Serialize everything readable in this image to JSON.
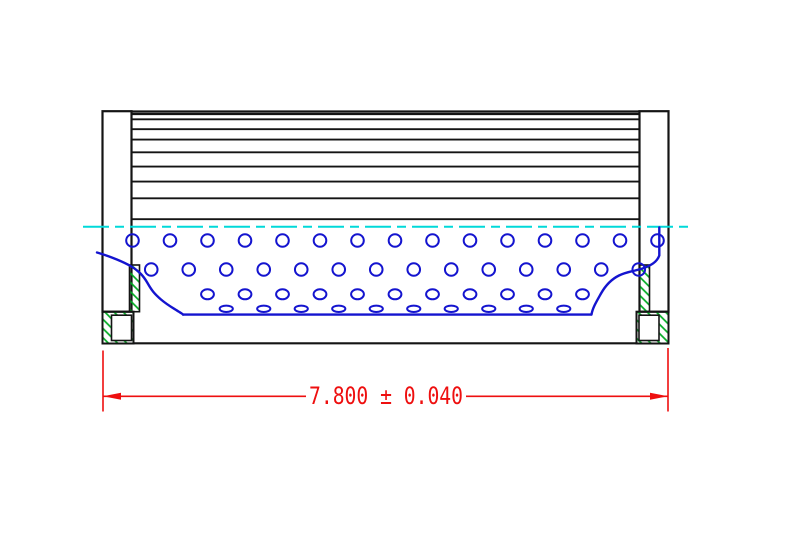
{
  "drawing": {
    "type": "cad-section-view-filter-element",
    "dimension": {
      "label": "7.800 ± 0.040",
      "nominal": "7.800",
      "tolerance": "0.040"
    },
    "colors": {
      "background": "#ffffff",
      "outline": "#141414",
      "perforation_blue": "#1414cf",
      "centerline_cyan": "#00d9d9",
      "hatch_green": "#00aa22",
      "dimension_red": "#ee0f0f"
    },
    "geometry": {
      "caps": [
        {
          "x": 102.5,
          "y": 111.2,
          "w": 29,
          "h": 200.5
        },
        {
          "x": 639.5,
          "y": 111.2,
          "w": 29,
          "h": 200.5
        }
      ],
      "strips": [
        {
          "x": 129.5,
          "y": 265,
          "w": 10,
          "h": 46.7
        },
        {
          "x": 639.5,
          "y": 265,
          "w": 10,
          "h": 46.7
        }
      ],
      "blocks": [
        {
          "outer": {
            "x": 102.5,
            "y": 311.7,
            "w": 31,
            "h": 31.8
          },
          "notch": {
            "x": 111.5,
            "y": 315.2,
            "w": 20,
            "h": 25.3
          }
        },
        {
          "outer": {
            "x": 636.5,
            "y": 311.7,
            "w": 32,
            "h": 31.8
          },
          "notch": {
            "x": 639.0,
            "y": 315.2,
            "w": 20,
            "h": 25.3
          }
        }
      ],
      "pleat_lines": {
        "x1": 131.5,
        "x2": 639.5,
        "ys": [
          111.5,
          114.0,
          119.3,
          129.2,
          139.6,
          152.3,
          166.6,
          181.6,
          198.3,
          219.2
        ]
      },
      "body_bottom": {
        "x1": 133.5,
        "x2": 636.5,
        "y": 343.3
      },
      "centerline": {
        "x1": 83,
        "x2": 690,
        "y": 226.8,
        "dash": "26 6 9 6"
      },
      "hole_rows": [
        {
          "cy": 240.5,
          "rx": 6.3,
          "ry": 6.3,
          "x0": 132.5,
          "dx": 37.5,
          "n": 15
        },
        {
          "cy": 269.5,
          "rx": 6.3,
          "ry": 6.3,
          "x0": 151.25,
          "dx": 37.5,
          "n": 14
        },
        {
          "cy": 294.3,
          "rx": 6.4,
          "ry": 5.0,
          "x0": 207.5,
          "dx": 37.5,
          "n": 11
        },
        {
          "cy": 308.8,
          "rx": 6.6,
          "ry": 3.2,
          "x0": 226.25,
          "dx": 37.5,
          "n": 10
        }
      ],
      "core_bottom": {
        "x1": 183,
        "x2": 591.5,
        "y": 314.6
      },
      "tear_curves": [
        "M 97 252.5 C 104 254.5 120 260 130.5 266 C 139 271 143.5 276 147.5 283 C 151.5 290 154 293.5 161 299.5 C 168 305.5 174 308.5 178.5 311.5 C 181.5 313.3 182.8 314 183 314.6",
        "M 659.3 227.5 L 659.3 255.5 C 657 262 651 265.5 642.5 268.5 C 634.5 271.2 627 271.5 619 275.5 C 611.5 279.2 605.5 285.5 601 293.5 C 596.5 301.5 592.5 308 591.5 314.6"
      ],
      "dim": {
        "y": 396.3,
        "ext": [
          {
            "x": 103,
            "y1": 350.5,
            "y2": 411.5
          },
          {
            "x": 668,
            "y1": 348.0,
            "y2": 411.5
          }
        ],
        "segs": [
          [
            103,
            306
          ],
          [
            466,
            668
          ]
        ],
        "arrows": [
          [
            103,
            396.3,
            1
          ],
          [
            668,
            396.3,
            -1
          ]
        ],
        "arrow_len": 18,
        "arrow_half_w": 3.5
      }
    }
  }
}
